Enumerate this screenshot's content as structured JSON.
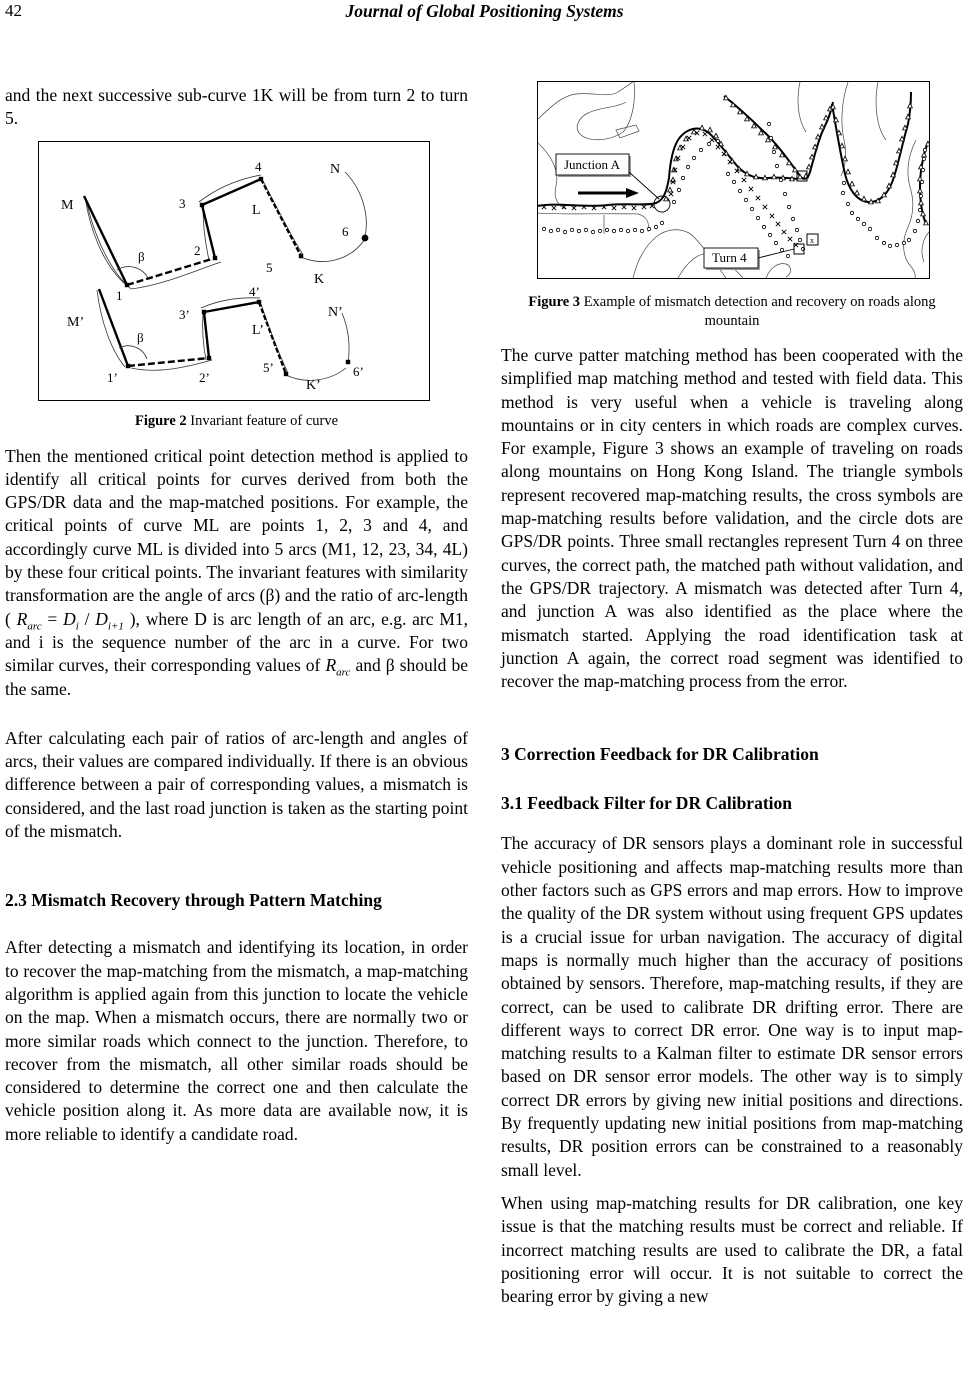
{
  "page": {
    "number": "42",
    "header_title": "Journal of Global Positioning Systems"
  },
  "left": {
    "intro": "and the next successive sub-curve 1K will be from turn 2 to turn 5.",
    "fig2": {
      "caption_bold": "Figure 2",
      "caption_rest": " Invariant feature of curve",
      "labels": {
        "M": "M",
        "p1": "1",
        "beta": "β",
        "p2": "2",
        "p3": "3",
        "p4": "4",
        "L": "L",
        "N": "N",
        "p5": "5",
        "K": "K",
        "p6": "6",
        "Mp": "M’",
        "p1p": "1’",
        "betap": "β",
        "p2p": "2’",
        "p3p": "3’",
        "p4p": "4’",
        "Lp": "L’",
        "Np": "N’",
        "p5p": "5’",
        "Kp": "K’",
        "p6p": "6’"
      }
    },
    "para1": {
      "t1": "Then the mentioned critical point detection method is applied to identify all critical points for curves derived from both the GPS/DR data and the map-matched positions. For example, the critical points of curve ML are points 1, 2, 3 and 4, and accordingly curve ML is divided into 5 arcs (M1, 12, 23, 34, 4L) by these four critical points. The invariant features with similarity transformation are the angle of arcs (β) and the ratio of arc-length ( ",
      "f_r": "R",
      "f_r_sub": "arc",
      "f_eq": " = ",
      "f_d1": "D",
      "f_d1_sub": "i",
      "f_slash": " / ",
      "f_d2": "D",
      "f_d2_sub": "i+1",
      "t2": " ), where D is arc length of an arc, e.g. arc M1, and i is the sequence number of the arc in a curve. For two similar curves, their corresponding values of ",
      "f_r2": "R",
      "f_r2_sub": "arc",
      "t3": " and β should be the same."
    },
    "para2": "After calculating each pair of ratios of arc-length and angles of arcs, their values are compared individually. If there is an obvious difference between a pair of corresponding values, a mismatch is considered, and the last road junction is taken as the starting point of the mismatch.",
    "heading_23": "2.3 Mismatch Recovery through Pattern Matching",
    "para3": "After detecting a mismatch and identifying its location, in order to recover the map-matching from the mismatch, a map-matching algorithm is applied again from this junction to locate the vehicle on the map. When a mismatch occurs, there are normally two or more similar roads which connect to the junction. Therefore, to recover from the mismatch, all other similar roads should be considered to determine the correct one and then calculate the vehicle position along it. As more data are available now, it is more reliable to identify a candidate road."
  },
  "right": {
    "fig3": {
      "junction_label": "Junction A",
      "turn_label": "Turn 4",
      "caption_bold": "Figure 3",
      "caption_rest": " Example of mismatch detection and recovery on roads along mountain"
    },
    "para1": "The curve patter matching method has been cooperated with the simplified map matching method and tested with field data. This method is very useful when a vehicle is traveling along mountains or in city centers in which roads are complex curves. For example, Figure 3 shows an example of traveling on roads along mountains on Hong Kong Island. The triangle symbols represent recovered map-matching results, the cross symbols are map-matching results before validation, and the circle dots are GPS/DR points. Three small rectangles represent Turn 4 on three curves, the correct path, the matched path without validation, and the GPS/DR trajectory. A mismatch was detected after Turn 4, and junction A was also identified as the place where the mismatch started. Applying the road identification task at junction A again, the correct road segment was identified to recover the map-matching process from the error.",
    "heading_3": "3 Correction Feedback for DR Calibration",
    "heading_31": "3.1 Feedback Filter for DR Calibration",
    "para2": "The accuracy of DR sensors plays a dominant role in successful vehicle positioning and affects map-matching results more than other factors such as GPS errors and map errors. How to improve the quality of the DR system without using frequent GPS updates is a crucial issue for urban navigation. The accuracy of digital maps is normally much higher than the accuracy of positions obtained by sensors. Therefore, map-matching results, if they are correct, can be used to calibrate DR drifting error. There are different ways to correct DR error. One way is to input map-matching results to a Kalman filter to estimate DR sensor errors based on DR sensor error models. The other way is to simply correct DR errors by giving new initial positions and directions. By frequently updating new initial positions from map-matching results, DR position errors can be constrained to a reasonably small level.",
    "para3": "When using map-matching results for DR calibration, one key issue is that the matching results must be correct and reliable. If incorrect matching results are used to calibrate the DR, a fatal positioning error will occur. It is not suitable to correct the bearing error by giving a new"
  }
}
